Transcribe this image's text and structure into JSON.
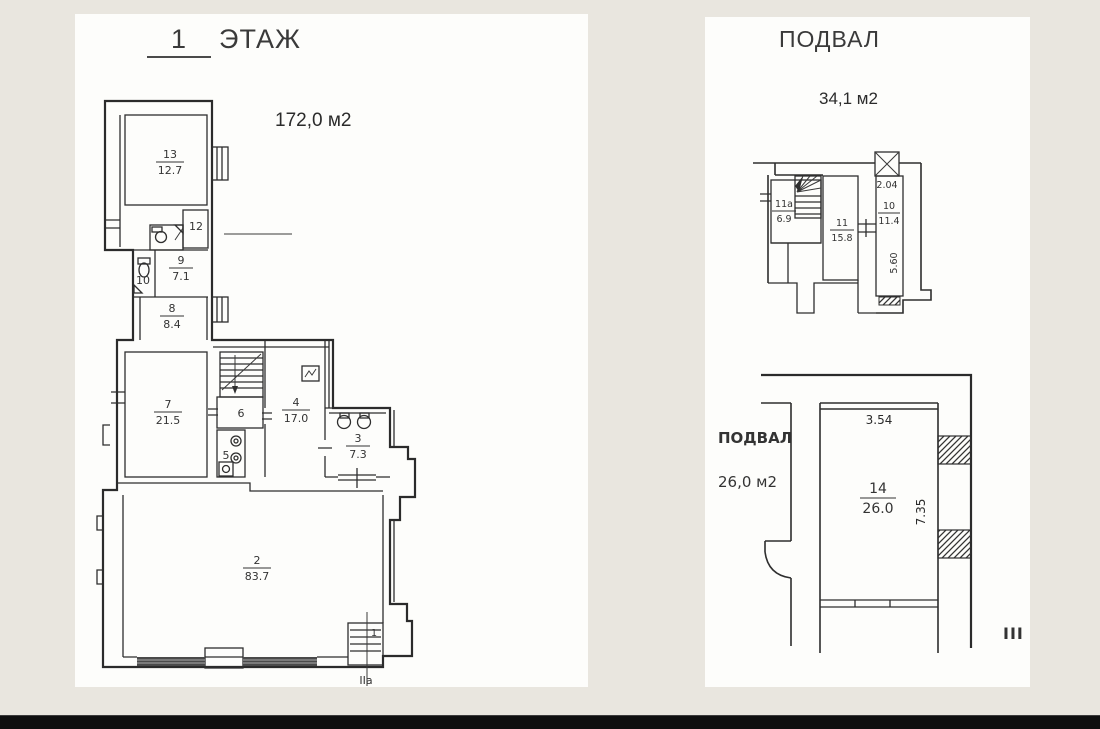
{
  "first_floor": {
    "title_num": "1",
    "title": "ЭТАЖ",
    "total_area": "172,0 м2",
    "rooms": {
      "r13": {
        "num": "13",
        "area": "12.7"
      },
      "r12": {
        "num": "12"
      },
      "r10": {
        "num": "10"
      },
      "r9": {
        "num": "9",
        "area": "7.1"
      },
      "r8": {
        "num": "8",
        "area": "8.4"
      },
      "r7": {
        "num": "7",
        "area": "21.5"
      },
      "r6": {
        "num": "6"
      },
      "r5": {
        "num": "5"
      },
      "r4": {
        "num": "4",
        "area": "17.0"
      },
      "r3": {
        "num": "3",
        "area": "7.3"
      },
      "r2": {
        "num": "2",
        "area": "83.7"
      },
      "r1": {
        "num": "1"
      }
    },
    "entrance_mark": "IIa"
  },
  "basement_upper": {
    "title": "ПОДВАЛ",
    "total_area": "34,1 м2",
    "rooms": {
      "r11a": {
        "num": "11а",
        "area": "6.9"
      },
      "r11": {
        "num": "11",
        "area": "15.8"
      },
      "r10": {
        "num": "10",
        "area": "11.4"
      }
    },
    "dims": {
      "w": "2.04",
      "h": "5.60"
    }
  },
  "basement_lower": {
    "label": "ПОДВАЛ",
    "area": "26,0 м2",
    "room": {
      "num": "14",
      "area": "26.0"
    },
    "dims": {
      "w": "3.54",
      "h": "7.35"
    },
    "section_mark": "III"
  },
  "colors": {
    "section_mark": "#c42a5c",
    "line": "#2b2b2b",
    "page_bg": "#e9e6df",
    "paper": "#fdfdfb",
    "bottom_bar": "#0f0f0f"
  }
}
